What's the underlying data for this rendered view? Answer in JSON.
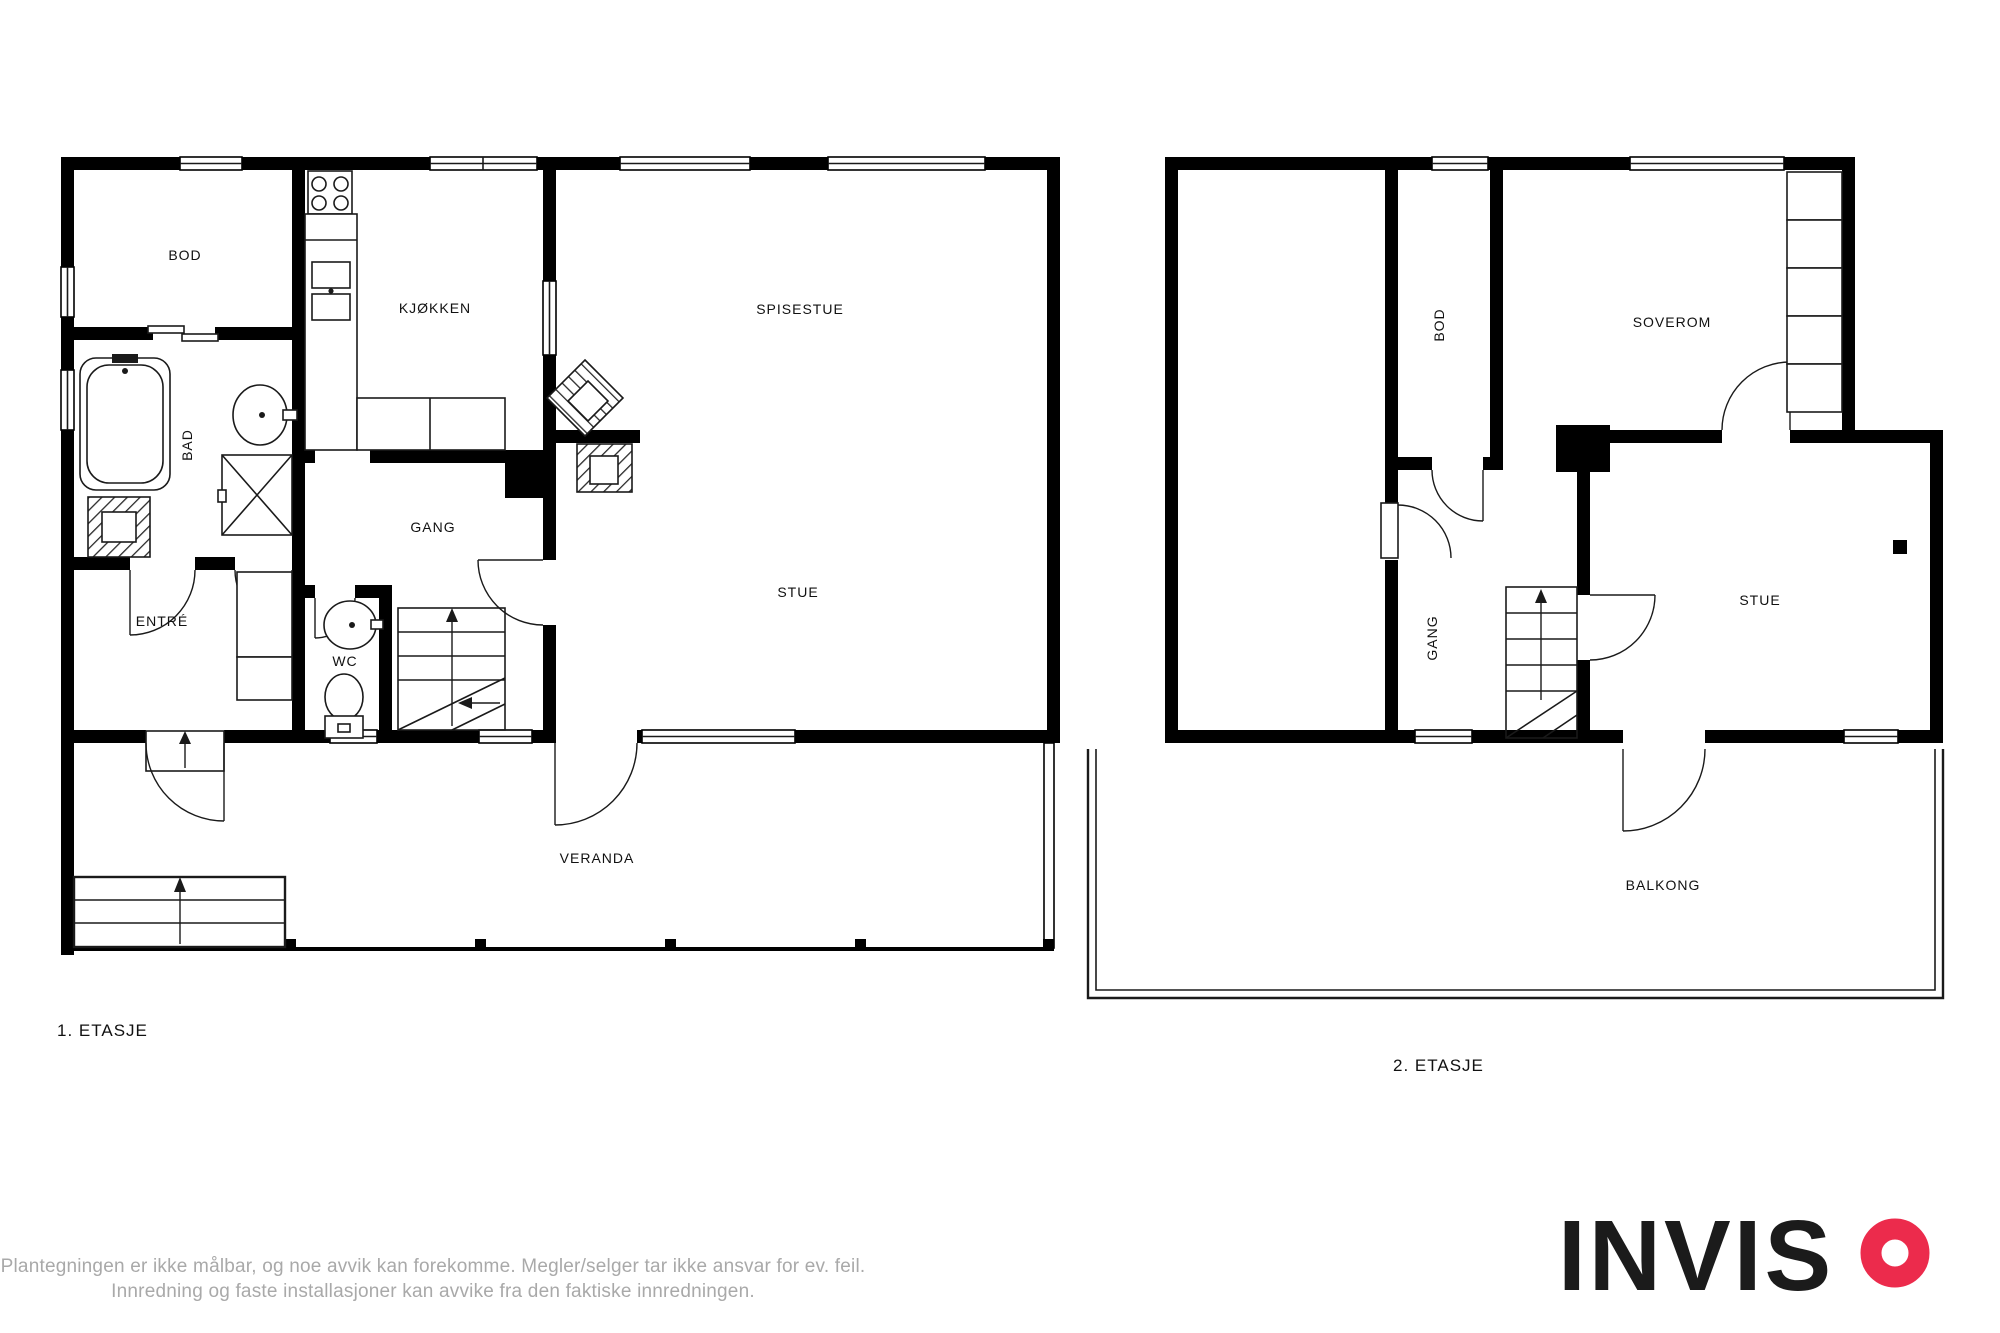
{
  "plan1": {
    "title": "1. ETASJE",
    "rooms": {
      "bod": "BOD",
      "kjokken": "KJØKKEN",
      "spisestue": "SPISESTUE",
      "bad": "BAD",
      "gang": "GANG",
      "stue": "STUE",
      "entre": "ENTRÉ",
      "wc": "WC",
      "veranda": "VERANDA"
    }
  },
  "plan2": {
    "title": "2. ETASJE",
    "rooms": {
      "bod": "BOD",
      "soverom": "SOVEROM",
      "gang": "GANG",
      "stue": "STUE",
      "balkong": "BALKONG"
    }
  },
  "disclaimer": {
    "line1": "Plantegningen er ikke målbar, og noe avvik kan forekomme. Megler/selger tar ikke ansvar for ev. feil.",
    "line2": "Innredning og faste installasjoner kan avvike fra den faktiske innredningen."
  },
  "branding": {
    "name": "INVISO",
    "wordmark_prefix": "INVIS",
    "accent_color": "#EC2B4C",
    "text_color": "#1b1b1b"
  }
}
